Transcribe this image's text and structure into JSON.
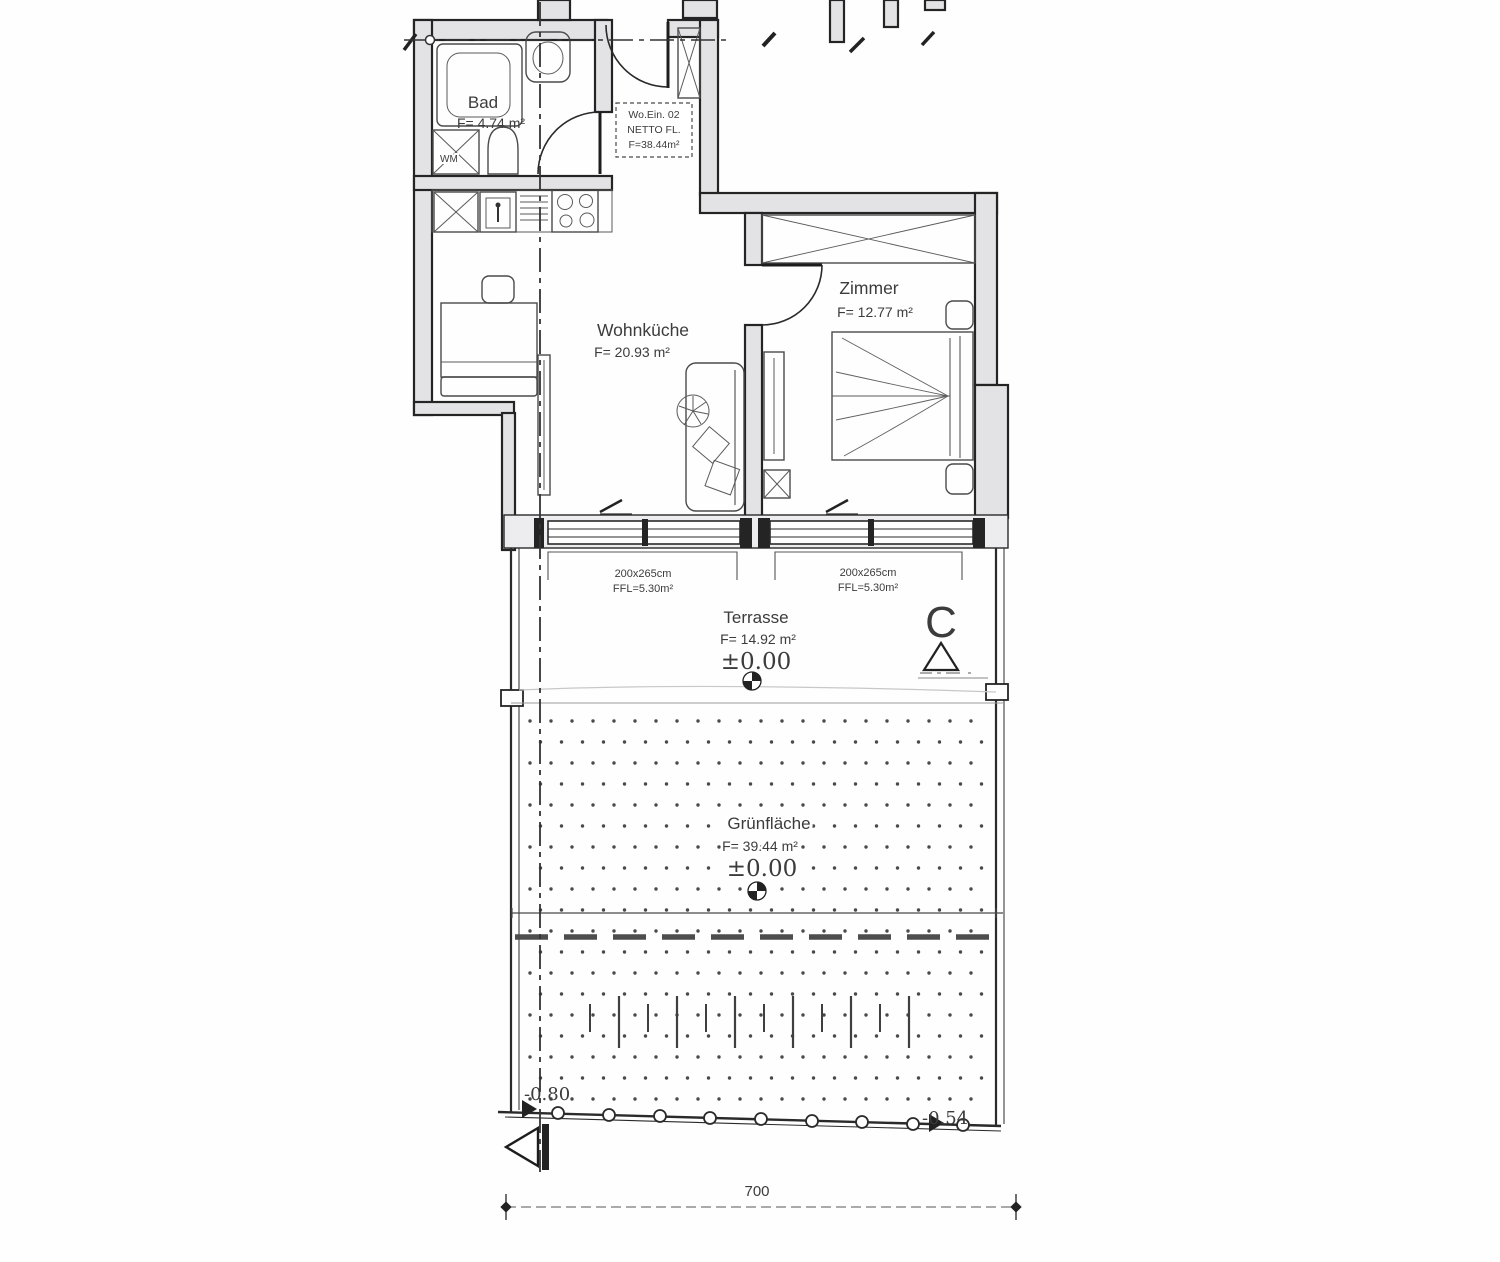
{
  "rooms": {
    "bad": {
      "name": "Bad",
      "area": "F= 4.74 m²"
    },
    "wohnkueche": {
      "name": "Wohnküche",
      "area": "F= 20.93 m²"
    },
    "zimmer": {
      "name": "Zimmer",
      "area": "F= 12.77 m²"
    },
    "terrasse": {
      "name": "Terrasse",
      "area": "F= 14.92 m²",
      "level": "±0.00"
    },
    "gruenflaeche": {
      "name": "Grünfläche",
      "area": "F= 39.44 m²",
      "level": "±0.00"
    }
  },
  "unit_box": {
    "line1": "Wo.Ein. 02",
    "line2": "NETTO FL.",
    "line3": "F=38.44m²"
  },
  "appliances": {
    "washing_machine": "WM"
  },
  "windows": {
    "left": {
      "size": "200x265cm",
      "area": "FFL=5.30m²"
    },
    "right": {
      "size": "200x265cm",
      "area": "FFL=5.30m²"
    }
  },
  "markers": {
    "section": "C"
  },
  "levels": {
    "bottom_left": "-0.80",
    "bottom_right": "-0.54"
  },
  "dimensions": {
    "total_width": "700"
  },
  "colors": {
    "wall_fill": "#e3e3e6",
    "line": "#242424",
    "text": "#3c3c3c",
    "dots": "#4a4a4a"
  }
}
